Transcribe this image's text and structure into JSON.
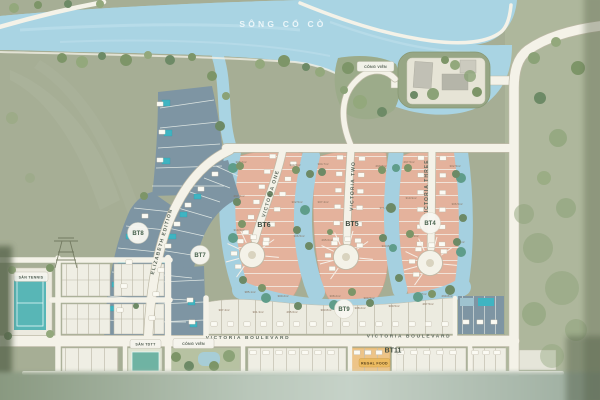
{
  "river": {
    "label": "SÔNG CỔ CÒ"
  },
  "streets": {
    "elizabeth": "ELIZABETH EDITION",
    "victoria_one": "VICTORIA ONE",
    "victoria_two": "VICTORIA TWO",
    "victoria_three": "VICTORIA THREE",
    "boulevard_left": "VICTORIA BOULEVARD",
    "boulevard_right": "VICTORIA BOULEVARD"
  },
  "blocks": {
    "bt4": "BT4",
    "bt5": "BT5",
    "bt6": "BT6",
    "bt7": "BT7",
    "bt8": "BT8",
    "bt9": "BT9",
    "bt11": "BT11"
  },
  "amenities": {
    "park_top": "CÔNG VIÊN",
    "park_bottom": "CÔNG VIÊN",
    "tennis": "SÂN TENNIS",
    "sports": "SÂN TDTT",
    "food_store": "REGAL FOOD"
  },
  "lot_areas": [
    "308.2m²",
    "300.5m²",
    "297.5m²",
    "302.5m²",
    "310.9m²",
    "306.5m²",
    "385.1m²",
    "300.2m²",
    "304.7m²",
    "299.8m²",
    "307.4m²",
    "301.3m²",
    "295.6m²",
    "303.8m²"
  ],
  "colors": {
    "land": "#a6ae95",
    "river": "#a9d4e3",
    "lagoon": "#a5d0e0",
    "lot_salmon": "#e4b29c",
    "lot_blue": "#7e95a3",
    "lot_white": "#efeee4",
    "road": "#f4f2e8",
    "pool": "#3fb4c2",
    "accent_food": "#ecbb60",
    "badge_text": "#47624d"
  }
}
